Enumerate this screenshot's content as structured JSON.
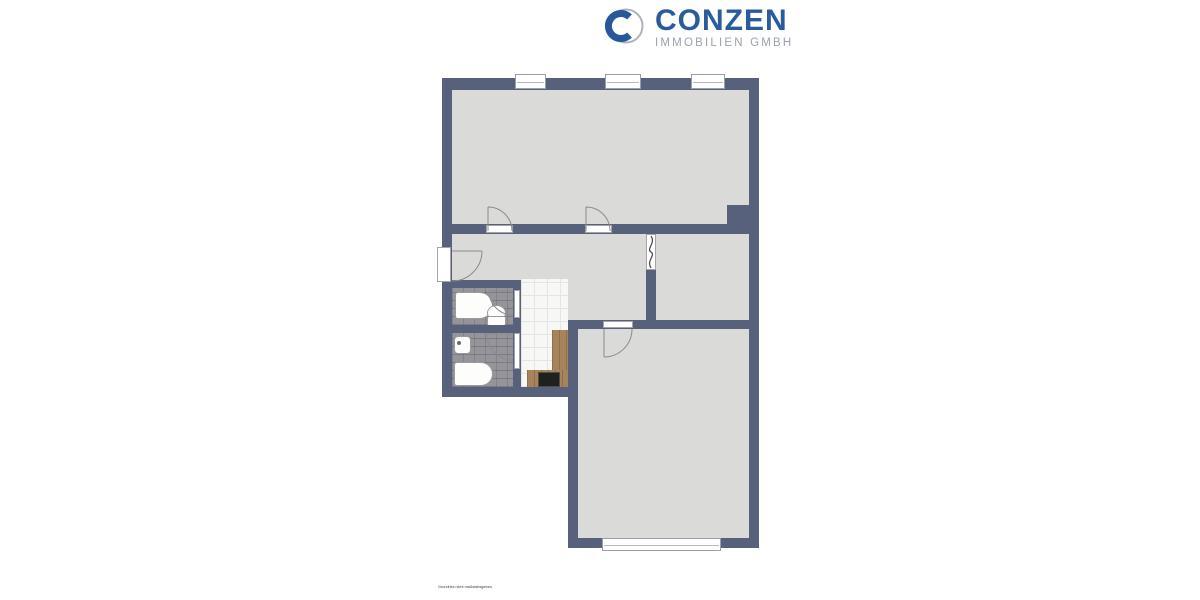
{
  "logo": {
    "brand": "CONZEN",
    "tagline": "IMMOBILIEN GMBH",
    "mark_icon": "c-ring-icon"
  },
  "plan_footnote": "Grundriss nicht maßstabsgetreu",
  "plan": {
    "type": "apartment-floor-plan",
    "fixtures_visible": [
      "bathtub",
      "toilet",
      "wash-basin",
      "bathtub",
      "kitchen-counter",
      "stove"
    ],
    "door_count": 7,
    "window_count": 4
  },
  "colors": {
    "background": "#ffffff",
    "wall": "#57617b",
    "floor": "#dadad8",
    "bathroom_tile": "#94949a",
    "kitchen_tile": "#f7f7f5",
    "counter_wood": "#a8845d",
    "stove": "#20201e",
    "logo_blue": "#2a5c9c",
    "logo_gray": "#9aa2ae"
  }
}
